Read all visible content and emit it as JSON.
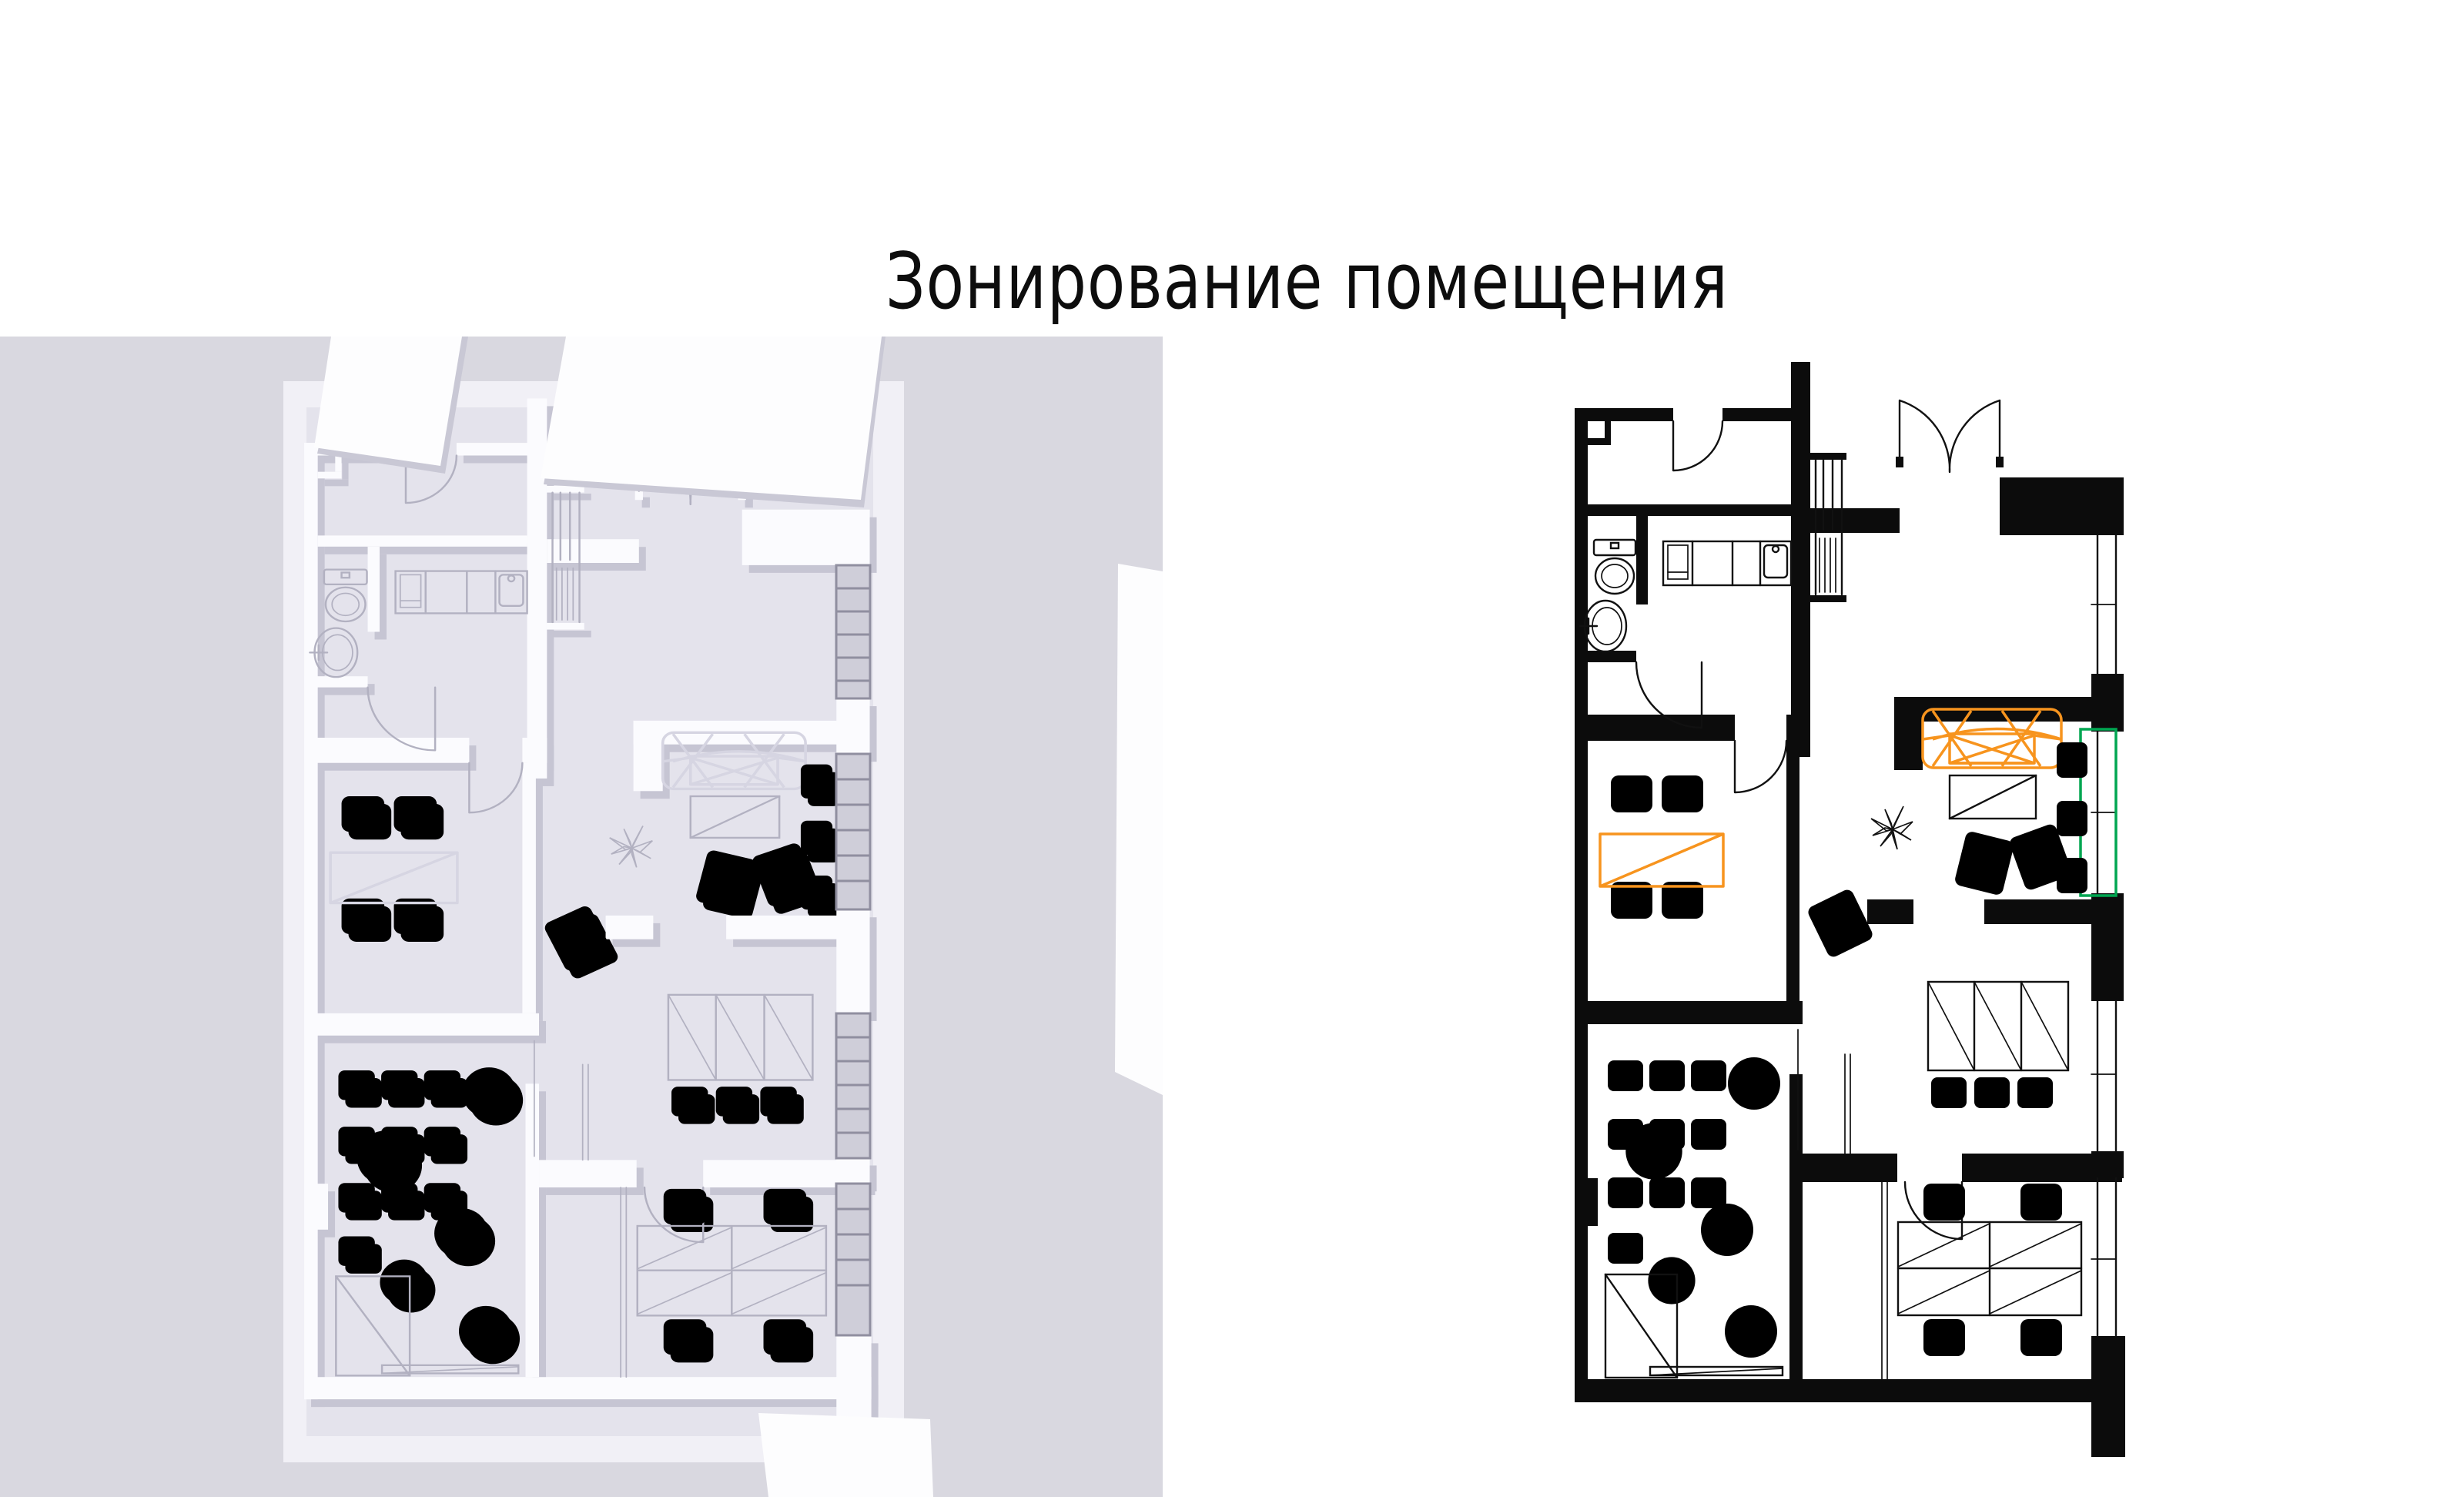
{
  "slide": {
    "title": "Зонирование помещения"
  },
  "colors": {
    "page_bg": "#ffffff",
    "render_bg": "#d9d8e0",
    "render_slab": "#f1f0f6",
    "render_floor": "#e4e3ec",
    "clay_wall": "#fbfbfe",
    "clay_shadow": "#c6c5d3",
    "clay_line": "#b2b1c1",
    "plan_ink": "#0c0c0c",
    "accent_orange": "#F7941E",
    "accent_green": "#00A651"
  },
  "render_3d": {
    "description": "3D clay top-down render of the premises",
    "rooms": [
      "vestibule",
      "bathroom",
      "kitchen",
      "entrance-hall",
      "meeting-room",
      "lounge",
      "classroom",
      "wardrobe-room",
      "office"
    ]
  },
  "plan_2d": {
    "description": "2D zoning floor plan",
    "highlighted_orange": [
      "sofa",
      "meeting-table"
    ],
    "highlighted_green": [
      "lounge-window-zone"
    ],
    "furniture": [
      "toilet",
      "sink",
      "kitchen-counter",
      "stairs",
      "armchairs",
      "easel",
      "plant",
      "sofa",
      "coffee-table",
      "lounge-chairs",
      "classroom-chairs",
      "poufs",
      "cabinet",
      "bench",
      "wardrobe",
      "office-desk",
      "office-chairs"
    ]
  }
}
